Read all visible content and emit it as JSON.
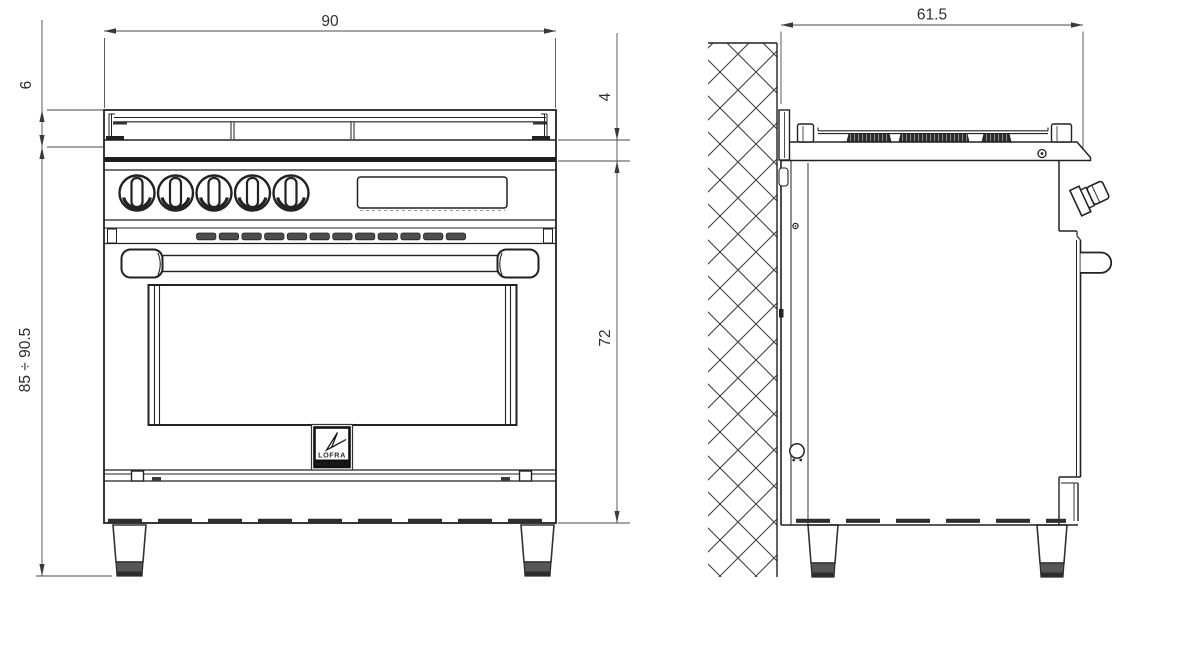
{
  "drawing": {
    "background_color": "#ffffff",
    "line_color": "#222222",
    "dimension_color": "#3a3a3a",
    "views": {
      "front": {
        "dimensions": {
          "overall_width_cm": "90",
          "grate_height_cm": "6",
          "overall_height_range_cm": "85 ÷ 90.5",
          "worktop_edge_cm": "4",
          "body_height_cm": "72"
        },
        "knob_count": 5,
        "vent_slot_count": 12
      },
      "side": {
        "dimensions": {
          "depth_cm": "61.5"
        }
      }
    },
    "logo": {
      "brand": "LOFRA",
      "tagline": "MADE IN ITALY"
    }
  }
}
